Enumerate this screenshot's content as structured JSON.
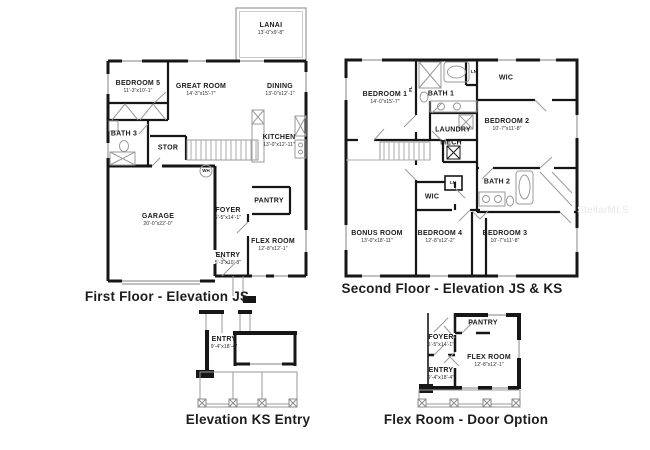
{
  "watermark": "StellarMLS",
  "colors": {
    "wall": "#161616",
    "thin_line": "#9a9a9a",
    "text": "#1b1b1b",
    "watermark": "#e7e7e7"
  },
  "first_floor": {
    "caption": "First Floor - Elevation JS",
    "rooms": {
      "lanai": {
        "name": "LANAI",
        "dims": "13'-0\"x9'-8\""
      },
      "bedroom5": {
        "name": "BEDROOM 5",
        "dims": "11'-3\"x10'-1\""
      },
      "great_room": {
        "name": "GREAT ROOM",
        "dims": "14'-3\"x15'-7\""
      },
      "dining": {
        "name": "DINING",
        "dims": "13'-0\"x12'-1\""
      },
      "kitchen": {
        "name": "KITCHEN",
        "dims": "13'-0\"x12'-11\""
      },
      "bath3": {
        "name": "BATH 3"
      },
      "stor": {
        "name": "STOR"
      },
      "wh": {
        "name": "WH"
      },
      "garage": {
        "name": "GARAGE",
        "dims": "20'-0\"x22'-0\""
      },
      "foyer": {
        "name": "FOYER",
        "dims": "5'-5\"x14'-1\""
      },
      "pantry": {
        "name": "PANTRY"
      },
      "flex_room": {
        "name": "FLEX ROOM",
        "dims": "12'-8\"x12'-1\""
      },
      "entry": {
        "name": "ENTRY",
        "dims": "5'-3\"x10'-8\""
      }
    }
  },
  "second_floor": {
    "caption": "Second Floor - Elevation JS & KS",
    "rooms": {
      "bedroom1": {
        "name": "BEDROOM 1",
        "dims": "14'-0\"x15'-7\""
      },
      "fl": {
        "name": "FL"
      },
      "bath1": {
        "name": "BATH 1"
      },
      "ln_upper": {
        "name": "LN"
      },
      "wic_upper": {
        "name": "WIC"
      },
      "laundry": {
        "name": "LAUNDRY"
      },
      "mech": {
        "name": "MECH"
      },
      "bedroom2": {
        "name": "BEDROOM 2",
        "dims": "10'-7\"x11'-8\""
      },
      "wic_lower": {
        "name": "WIC"
      },
      "ln_lower": {
        "name": "LN"
      },
      "bath2": {
        "name": "BATH 2"
      },
      "bonus_room": {
        "name": "BONUS ROOM",
        "dims": "13'-0\"x18'-11\""
      },
      "bedroom4": {
        "name": "BEDROOM 4",
        "dims": "12'-8\"x12'-2\""
      },
      "bedroom3": {
        "name": "BEDROOM 3",
        "dims": "10'-7\"x11'-8\""
      }
    }
  },
  "ks_entry": {
    "caption": "Elevation KS Entry",
    "rooms": {
      "entry": {
        "name": "ENTRY",
        "dims": "9'-4\"x18'-4\""
      }
    }
  },
  "flex_option": {
    "caption": "Flex Room - Door Option",
    "rooms": {
      "pantry": {
        "name": "PANTRY"
      },
      "foyer": {
        "name": "FOYER",
        "dims": "5'-5\"x14'-1\""
      },
      "flex_room": {
        "name": "FLEX ROOM",
        "dims": "12'-8\"x12'-1\""
      },
      "entry": {
        "name": "ENTRY",
        "dims": "9'-4\"x18'-4\""
      }
    }
  }
}
